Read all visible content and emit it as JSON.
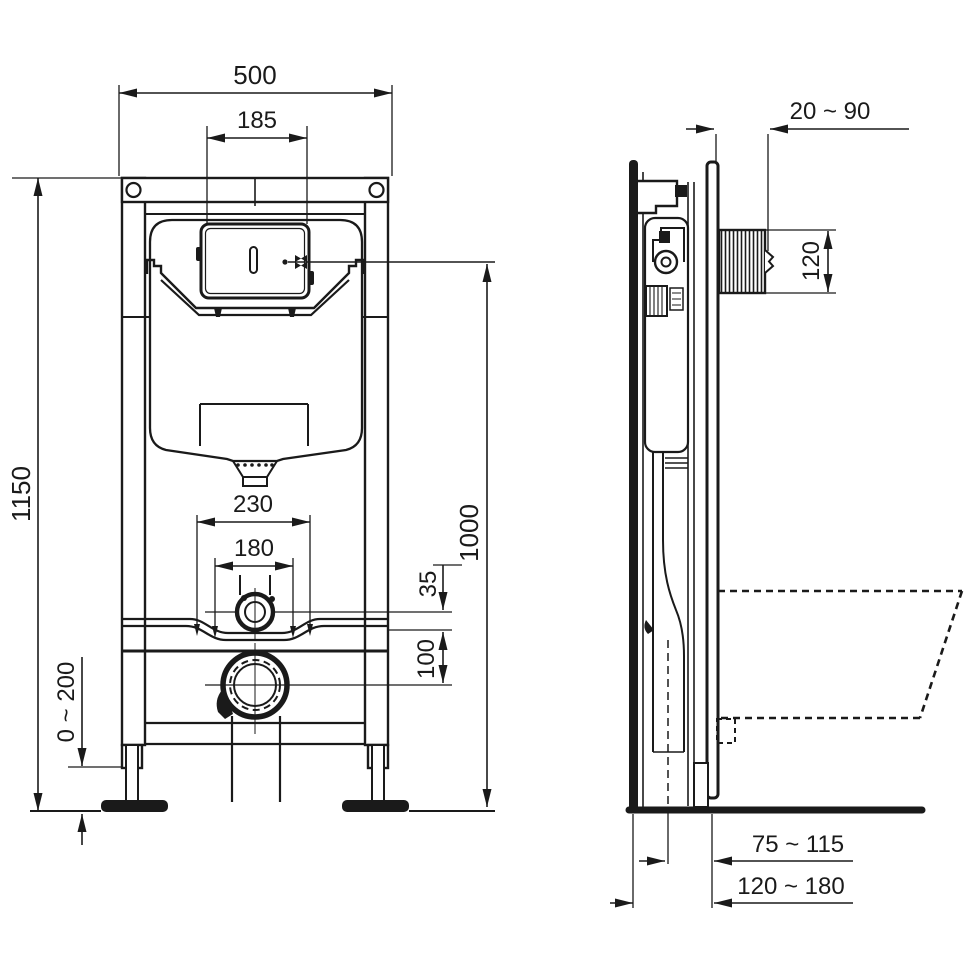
{
  "drawing": {
    "description": "Technical installation drawing of a wall-hung WC concealed cistern frame, front view and side view, with millimetre dimensions",
    "colors": {
      "line": "#1a1a1a",
      "background": "#ffffff"
    },
    "dims": {
      "overall_width": "500",
      "flush_plate_opening_width": "185",
      "frame_height": "1150",
      "foot_adjustment": "0 ~ 200",
      "fixing_centers_outer": "230",
      "fixing_centers_inner": "180",
      "flush_bend_offset": "35",
      "pipe_centers_distance": "100",
      "flush_panel_height": "1000",
      "wall_finish_depth": "20 ~ 90",
      "recess_height": "120",
      "outlet_center_to_front": "75 ~ 115",
      "frame_depth_range": "120 ~ 180"
    }
  }
}
